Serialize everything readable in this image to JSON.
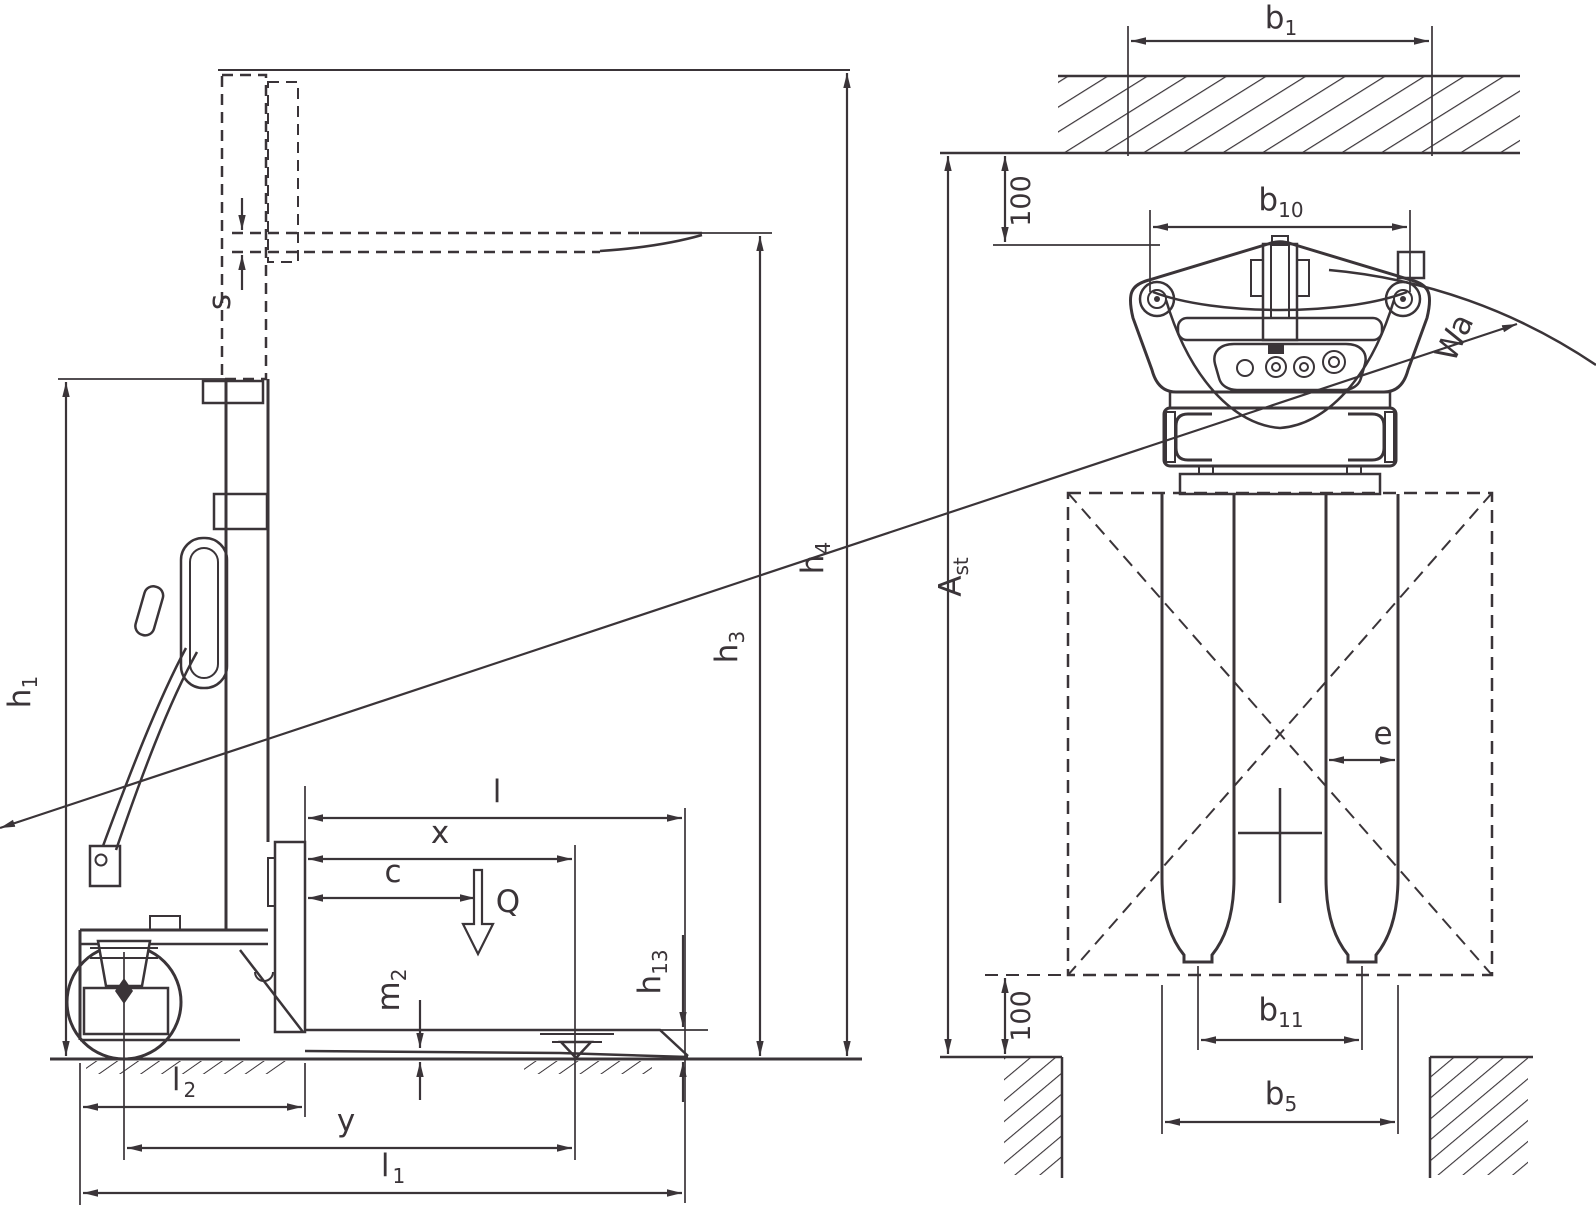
{
  "colors": {
    "line": "#3a3438",
    "background": "#ffffff"
  },
  "dims": {
    "h1": {
      "base": "h",
      "sub": "1"
    },
    "s": {
      "base": "s",
      "sub": ""
    },
    "l": {
      "base": "l",
      "sub": ""
    },
    "x": {
      "base": "x",
      "sub": ""
    },
    "c": {
      "base": "c",
      "sub": ""
    },
    "q": {
      "base": "Q",
      "sub": ""
    },
    "m2": {
      "base": "m",
      "sub": "2"
    },
    "h13": {
      "base": "h",
      "sub": "13"
    },
    "h3": {
      "base": "h",
      "sub": "3"
    },
    "h4": {
      "base": "h",
      "sub": "4"
    },
    "l2": {
      "base": "l",
      "sub": "2"
    },
    "y": {
      "base": "y",
      "sub": ""
    },
    "l1": {
      "base": "l",
      "sub": "1"
    },
    "b1": {
      "base": "b",
      "sub": "1"
    },
    "clearance_top": {
      "base": "100",
      "sub": ""
    },
    "b10": {
      "base": "b",
      "sub": "10"
    },
    "ast": {
      "base": "A",
      "sub": "st"
    },
    "wa": {
      "base": "Wa",
      "sub": ""
    },
    "e": {
      "base": "e",
      "sub": ""
    },
    "clearance_bottom": {
      "base": "100",
      "sub": ""
    },
    "b11": {
      "base": "b",
      "sub": "11"
    },
    "b5": {
      "base": "b",
      "sub": "5"
    }
  }
}
